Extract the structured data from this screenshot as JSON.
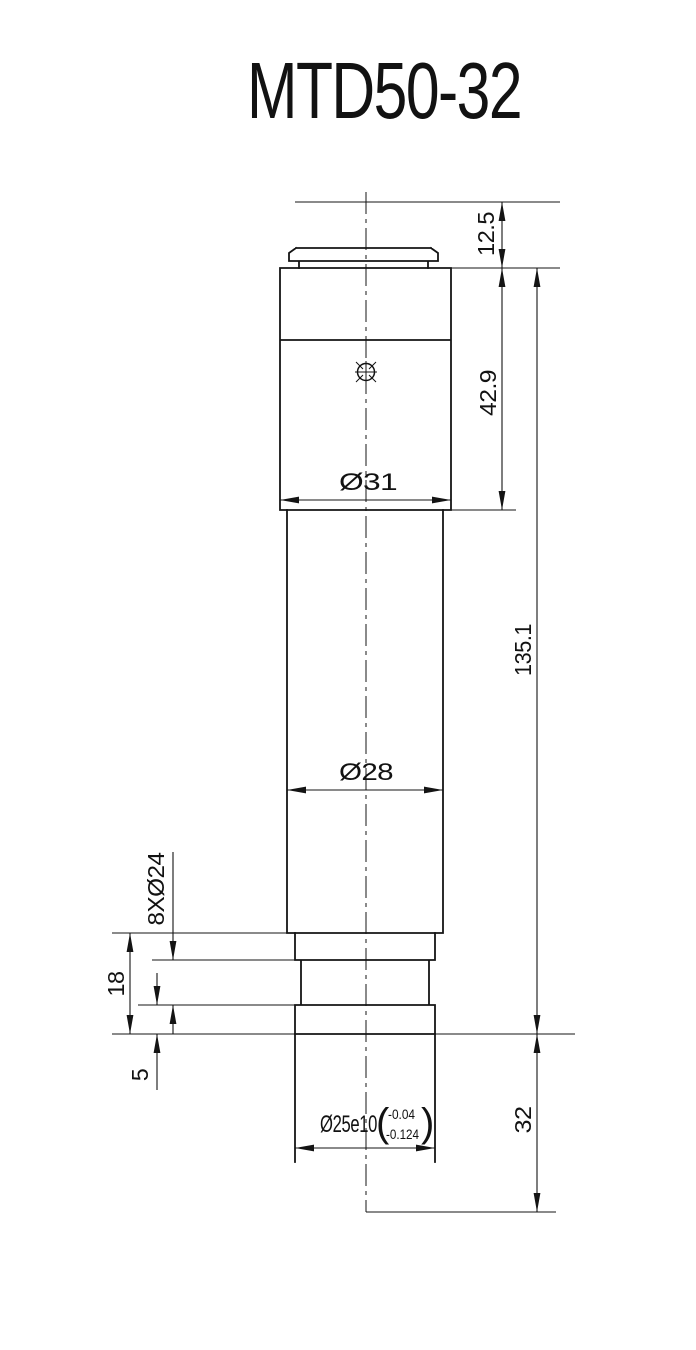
{
  "title": "MTD50-32",
  "dimensions": {
    "cap_height": "12.5",
    "upper_body_height": "42.9",
    "upper_body_diameter": "Ø31",
    "overall_body_height": "135.1",
    "tube_diameter": "Ø28",
    "flange_label": "8XØ24",
    "flange_total_height": "18",
    "flange_step_height": "5",
    "insert_diameter": "Ø25e10",
    "insert_tolerance": {
      "open": "(",
      "upper": "-0.04",
      "lower": "-0.124",
      "close": ")"
    },
    "insert_length": "32"
  }
}
